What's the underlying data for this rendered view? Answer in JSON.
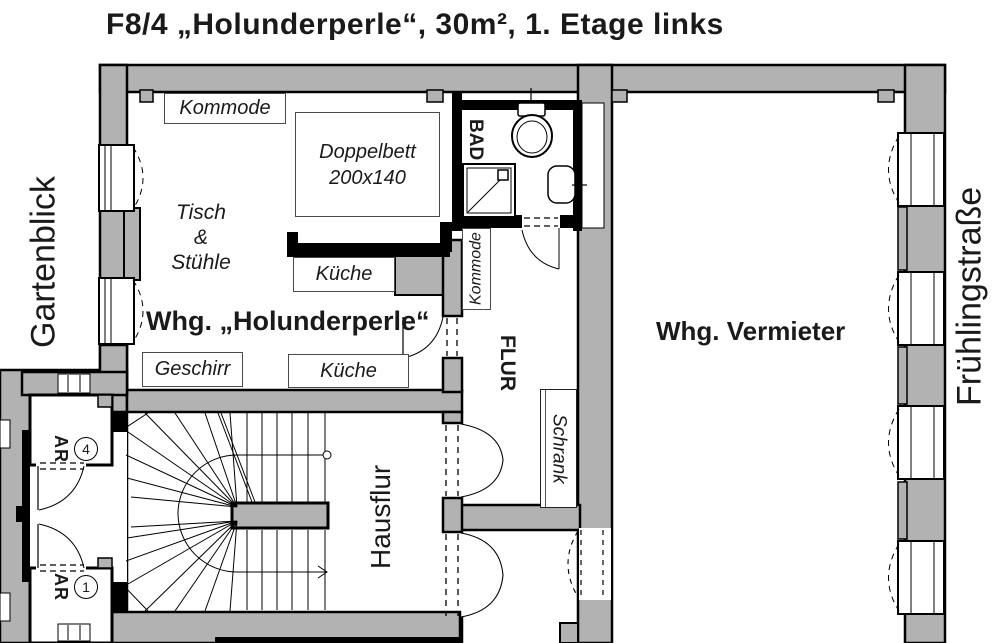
{
  "title": "F8/4 „Holunderperle“, 30m², 1. Etage links",
  "streets": {
    "left": "Gartenblick",
    "right": "Frühlingstraße"
  },
  "holunderperle": {
    "name": "Whg. „Holunderperle“",
    "kommode": "Kommode",
    "bed": {
      "label": "Doppelbett",
      "size": "200x140"
    },
    "tisch": "Tisch",
    "tisch_amp": "&",
    "stuehle": "Stühle",
    "kueche_upper": "Küche",
    "kueche_lower": "Küche",
    "geschirr": "Geschirr"
  },
  "bad": {
    "label": "BAD"
  },
  "flur": {
    "label": "FLUR",
    "kommode": "Kommode",
    "schrank": "Schrank"
  },
  "hausflur": {
    "label": "Hausflur"
  },
  "vermieter": {
    "name": "Whg. Vermieter"
  },
  "storage_rooms": [
    {
      "label": "AR",
      "number": "4"
    },
    {
      "label": "AR",
      "number": "1"
    }
  ],
  "colors": {
    "wall": "#b2b2b2",
    "line": "#000000"
  }
}
